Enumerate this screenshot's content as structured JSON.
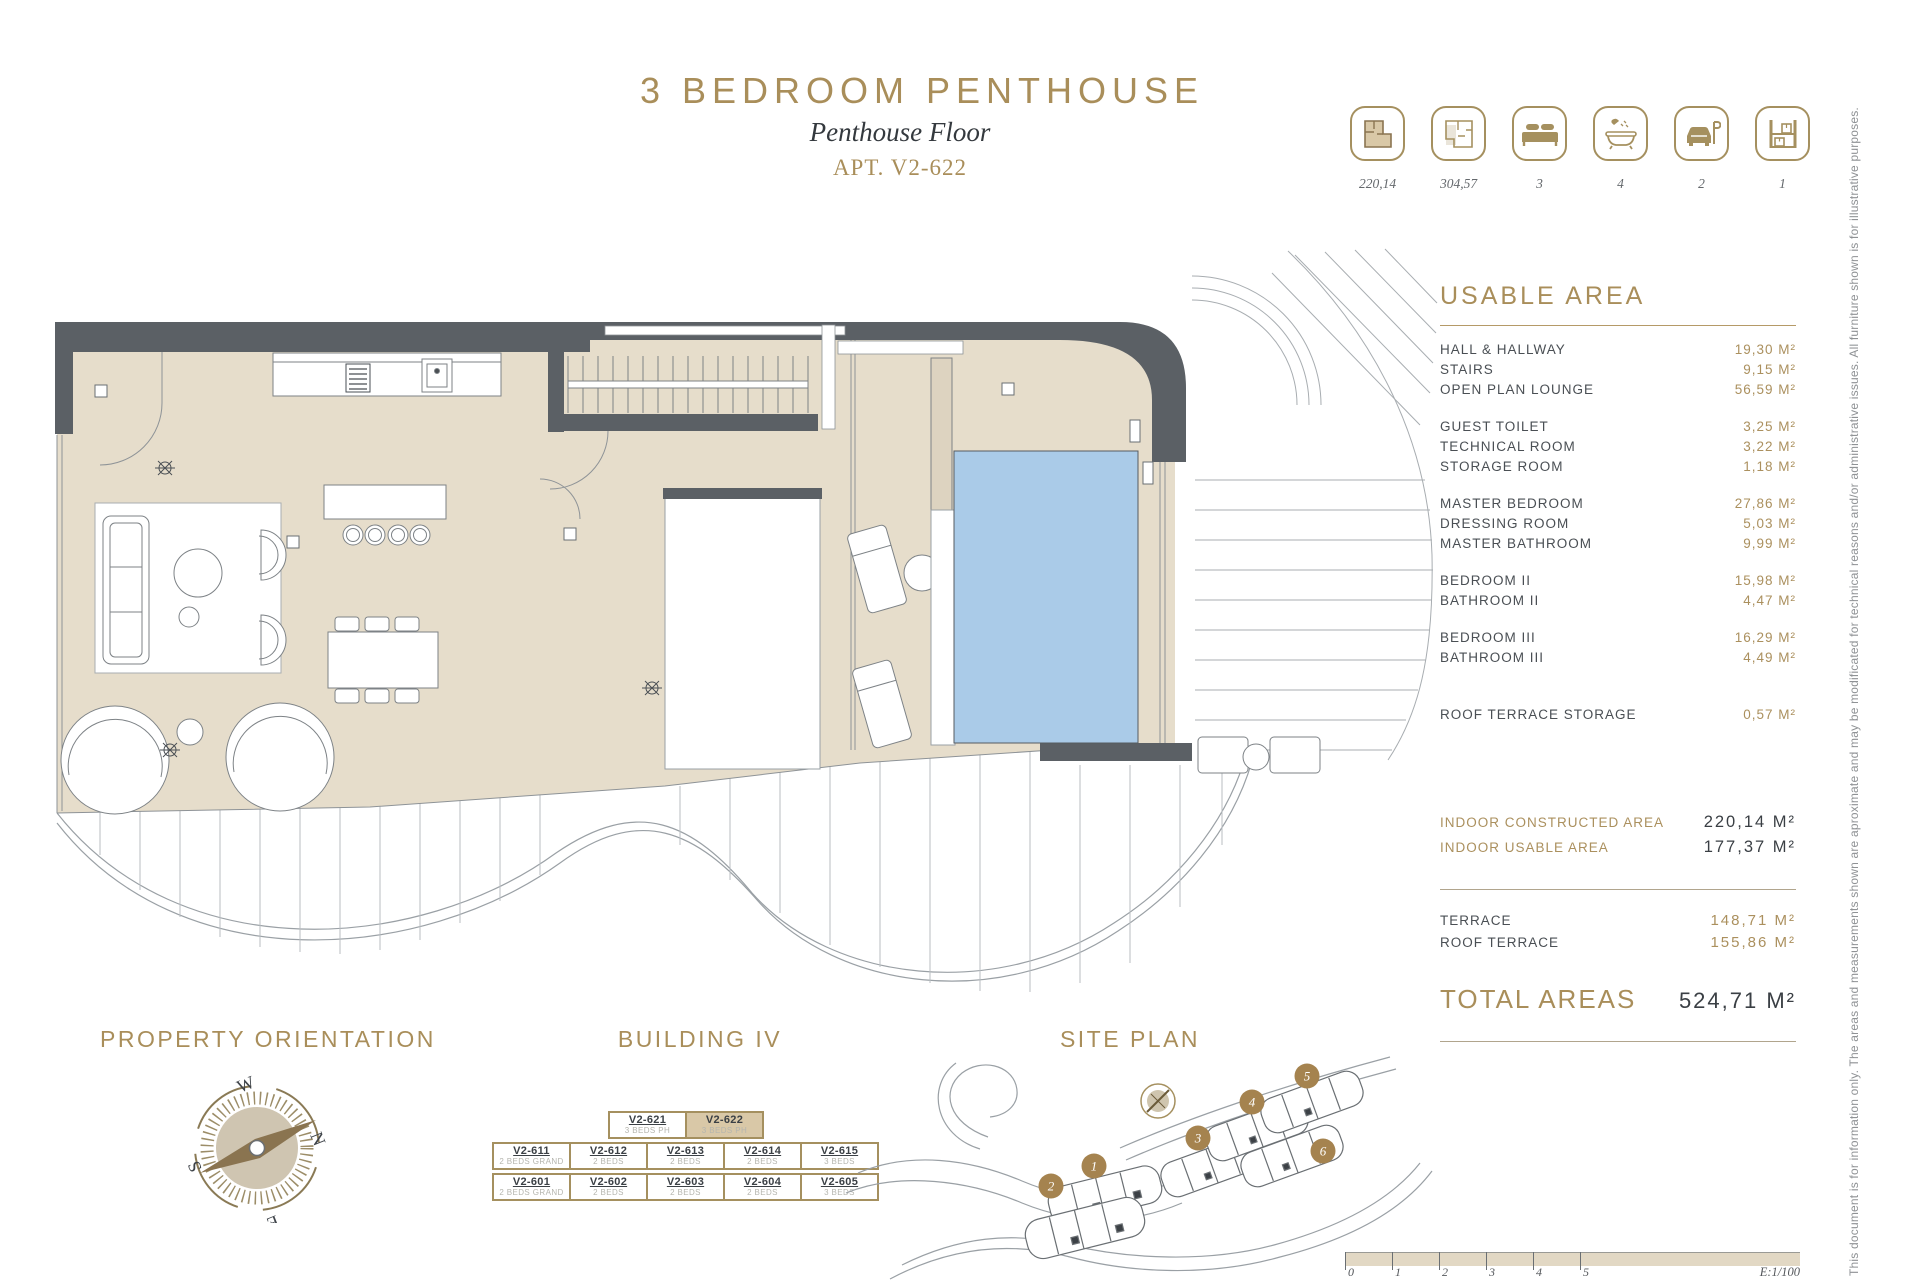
{
  "accent": "#a98e5a",
  "title": {
    "main": "3 BEDROOM PENTHOUSE",
    "sub": "Penthouse Floor",
    "apt": "APT. V2-622"
  },
  "summary": [
    {
      "icon": "constructed-area-plan-icon",
      "value": "220,14"
    },
    {
      "icon": "total-area-plan-icon",
      "value": "304,57"
    },
    {
      "icon": "bedrooms-icon",
      "value": "3"
    },
    {
      "icon": "bathrooms-icon",
      "value": "4"
    },
    {
      "icon": "parking-icon",
      "value": "2"
    },
    {
      "icon": "storage-icon",
      "value": "1"
    }
  ],
  "usable_area": {
    "heading": "USABLE AREA",
    "rooms": [
      {
        "label": "HALL & HALLWAY",
        "value": "19,30 M²"
      },
      {
        "label": "STAIRS",
        "value": "9,15 M²"
      },
      {
        "label": "OPEN PLAN LOUNGE",
        "value": "56,59 M²"
      },
      {
        "label": "GUEST TOILET",
        "value": "3,25 M²"
      },
      {
        "label": "TECHNICAL ROOM",
        "value": "3,22 M²"
      },
      {
        "label": "STORAGE ROOM",
        "value": "1,18 M²"
      },
      {
        "label": "MASTER BEDROOM",
        "value": "27,86 M²"
      },
      {
        "label": "DRESSING ROOM",
        "value": "5,03 M²"
      },
      {
        "label": "MASTER BATHROOM",
        "value": "9,99 M²"
      },
      {
        "label": "BEDROOM II",
        "value": "15,98 M²"
      },
      {
        "label": "BATHROOM II",
        "value": "4,47 M²"
      },
      {
        "label": "BEDROOM III",
        "value": "16,29 M²"
      },
      {
        "label": "BATHROOM III",
        "value": "4,49 M²"
      },
      {
        "label": "ROOF TERRACE STORAGE",
        "value": "0,57 M²"
      }
    ]
  },
  "indoor_totals": [
    {
      "label": "INDOOR CONSTRUCTED AREA",
      "value": "220,14 M²"
    },
    {
      "label": "INDOOR USABLE AREA",
      "value": "177,37 M²"
    }
  ],
  "terrace_totals": [
    {
      "label": "TERRACE",
      "value": "148,71 M²"
    },
    {
      "label": "ROOF TERRACE",
      "value": "155,86 M²"
    }
  ],
  "total": {
    "label": "TOTAL AREAS",
    "value": "524,71 M²"
  },
  "orientation": {
    "heading": "PROPERTY ORIENTATION",
    "n": "N",
    "s": "S",
    "e": "E",
    "w": "W"
  },
  "building": {
    "heading": "BUILDING IV",
    "top": [
      {
        "code": "V2-621",
        "type": "3 BEDS PH"
      },
      {
        "code": "V2-622",
        "type": "3 BEDS PH"
      }
    ],
    "mid": [
      {
        "code": "V2-611",
        "type": "2 BEDS GRAND"
      },
      {
        "code": "V2-612",
        "type": "2 BEDS"
      },
      {
        "code": "V2-613",
        "type": "2 BEDS"
      },
      {
        "code": "V2-614",
        "type": "2 BEDS"
      },
      {
        "code": "V2-615",
        "type": "3 BEDS"
      }
    ],
    "bottom": [
      {
        "code": "V2-601",
        "type": "2 BEDS GRAND"
      },
      {
        "code": "V2-602",
        "type": "2 BEDS"
      },
      {
        "code": "V2-603",
        "type": "2 BEDS"
      },
      {
        "code": "V2-604",
        "type": "2 BEDS"
      },
      {
        "code": "V2-605",
        "type": "3 BEDS"
      }
    ]
  },
  "site_plan": {
    "heading": "SITE PLAN",
    "markers": [
      "1",
      "2",
      "3",
      "4",
      "5",
      "6"
    ]
  },
  "scale_bar": {
    "ticks": [
      "0",
      "1",
      "2",
      "3",
      "4",
      "5"
    ],
    "scale": "E:1/100"
  },
  "disclaimer": "This document is for information only. The areas and measurements shown are aproximate and may be modificated for technical reasons and/or administrative issues. All furniture shown is for illustrative purposes.",
  "colors": {
    "wall": "#5b6065",
    "floor": "#e6ddcb",
    "pool": "#aacbe8",
    "highlight": "#d9c8a7"
  }
}
